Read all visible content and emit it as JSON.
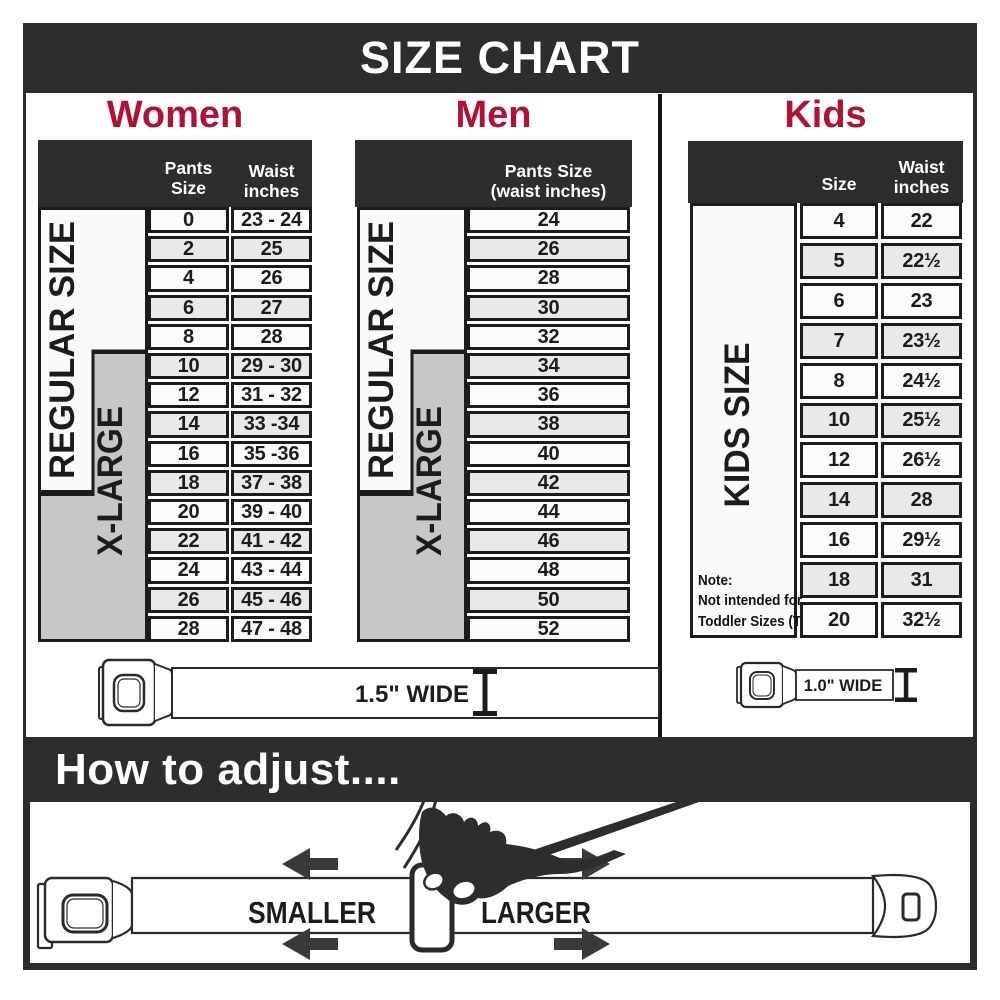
{
  "title": "SIZE CHART",
  "colors": {
    "accent": "#b01236",
    "dark": "#2e2c2d",
    "line": "#1c1c1c",
    "row_alt": "#e9e9e9",
    "label_gray": "#c7c7c7"
  },
  "sections": {
    "women": {
      "label": "Women",
      "col1_header": "Pants Size",
      "col2_header_line1": "Waist",
      "col2_header_line2": "inches",
      "regular_label": "REGULAR SIZE",
      "xlarge_label": "X-LARGE",
      "rows": [
        [
          "0",
          "23 - 24"
        ],
        [
          "2",
          "25"
        ],
        [
          "4",
          "26"
        ],
        [
          "6",
          "27"
        ],
        [
          "8",
          "28"
        ],
        [
          "10",
          "29 - 30"
        ],
        [
          "12",
          "31 - 32"
        ],
        [
          "14",
          "33 -34"
        ],
        [
          "16",
          "35 -36"
        ],
        [
          "18",
          "37 - 38"
        ],
        [
          "20",
          "39 - 40"
        ],
        [
          "22",
          "41 - 42"
        ],
        [
          "24",
          "43 - 44"
        ],
        [
          "26",
          "45 - 46"
        ],
        [
          "28",
          "47 - 48"
        ]
      ]
    },
    "men": {
      "label": "Men",
      "header_line1": "Pants Size",
      "header_line2": "(waist inches)",
      "regular_label": "REGULAR SIZE",
      "xlarge_label": "X-LARGE",
      "rows": [
        [
          "24"
        ],
        [
          "26"
        ],
        [
          "28"
        ],
        [
          "30"
        ],
        [
          "32"
        ],
        [
          "34"
        ],
        [
          "36"
        ],
        [
          "38"
        ],
        [
          "40"
        ],
        [
          "42"
        ],
        [
          "44"
        ],
        [
          "46"
        ],
        [
          "48"
        ],
        [
          "50"
        ],
        [
          "52"
        ]
      ]
    },
    "kids": {
      "label": "Kids",
      "col1_header": "Size",
      "col2_header_line1": "Waist",
      "col2_header_line2": "inches",
      "size_label": "KIDS SIZE",
      "note_line1": "Note:",
      "note_line2": "Not intended for",
      "note_line3": "Toddler Sizes (T)",
      "rows": [
        [
          "4",
          "22"
        ],
        [
          "5",
          "22½"
        ],
        [
          "6",
          "23"
        ],
        [
          "7",
          "23½"
        ],
        [
          "8",
          "24½"
        ],
        [
          "10",
          "25½"
        ],
        [
          "12",
          "26½"
        ],
        [
          "14",
          "28"
        ],
        [
          "16",
          "29½"
        ],
        [
          "18",
          "31"
        ],
        [
          "20",
          "32½"
        ]
      ]
    }
  },
  "belts": {
    "women_men_width_label": "1.5\" WIDE",
    "kids_width_label": "1.0\" WIDE"
  },
  "adjust": {
    "heading": "How to adjust....",
    "smaller_label": "SMALLER",
    "larger_label": "LARGER"
  }
}
